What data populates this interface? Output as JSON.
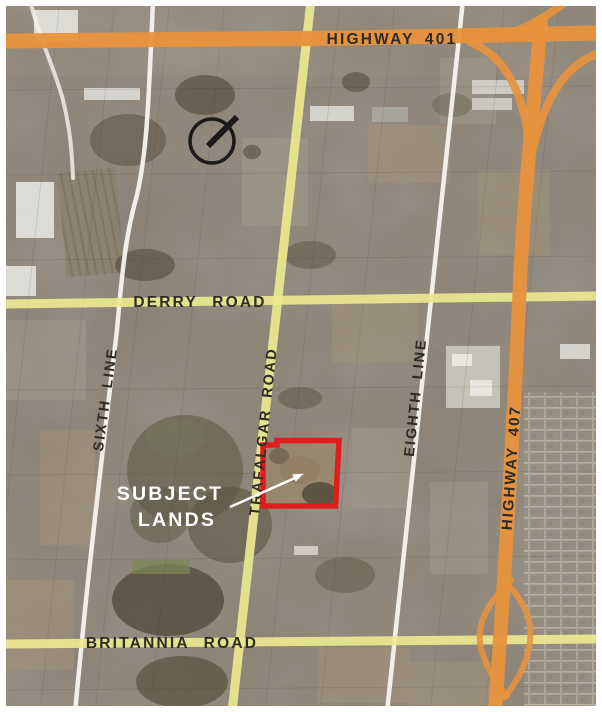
{
  "figure": {
    "type": "aerial-location-map",
    "annotation": {
      "line1": "SUBJECT",
      "line2": "LANDS"
    }
  },
  "roads": {
    "highway_401": "HIGHWAY 401",
    "highway_407": "HIGHWAY 407",
    "derry_road": "DERRY ROAD",
    "britannia_road": "BRITANNIA ROAD",
    "trafalgar_road": "TRAFALGAR ROAD",
    "sixth_line": "SIXTH LINE",
    "eighth_line": "EIGHTH LINE"
  },
  "colors": {
    "highway": "#e8923c",
    "arterial": "#ece88f",
    "local_road": "#f5f4ef",
    "subject_outline": "#e01c1c",
    "road_label": "#2e2b25",
    "annotation_text": "#ffffff",
    "north_symbol": "#1b1b1b"
  }
}
